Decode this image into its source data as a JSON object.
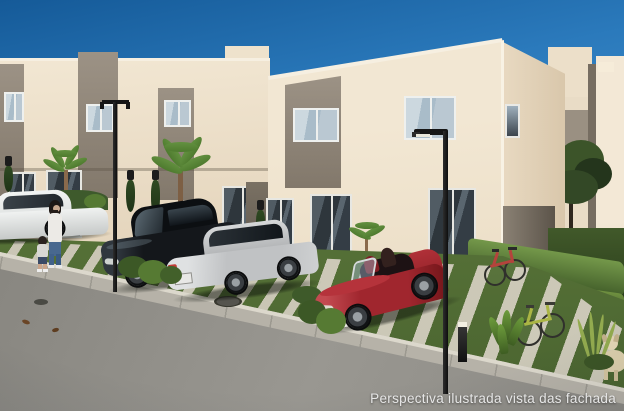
{
  "caption": {
    "text": "Perspectiva ilustrada vista das fachada"
  },
  "scene": {
    "type": "architectural-rendering",
    "subject": "Street-level view of a row of two-story beige townhouses with taupe accent panels, landscaped front yards crossed by diagonal paver walkways, parked cars (white, black, silver sedans and a red convertible), street lamps, a woman walking with a child, two bicycles, a small dog and a cobblestone street",
    "objects": [
      "sky",
      "townhouse-row",
      "front-townhouse",
      "background-buildings",
      "tree",
      "lawn",
      "paver-walkways",
      "sidewalk",
      "curb",
      "cobblestone-street",
      "manhole",
      "white-sedan",
      "black-sedan",
      "silver-sedan",
      "red-convertible",
      "street-lamp-left",
      "street-lamp-right",
      "bollard-light",
      "woman-pedestrian",
      "child-pedestrian",
      "red-bicycle",
      "green-bicycle",
      "dog",
      "palm-trees",
      "hedges",
      "shrubs",
      "wall-sconces"
    ]
  },
  "palette": {
    "sky-top": "#155a98",
    "sky-mid": "#2b7abc",
    "sky-low": "#5fa3d4",
    "wall": "#efe3ce",
    "wall-shade": "#e2d2b9",
    "wall-dark": "#6e6559",
    "accent": "#948a7c",
    "accent-dark": "#82786b",
    "roof-light": "#f6efe1",
    "frame": "#eef0ee",
    "glass-sky": "#a9bcc9",
    "glass-dark": "#343d45",
    "grass": "#5d7b3f",
    "grass-dark": "#465f2d",
    "paver": "#cfcaba",
    "sidewalk": "#b6b2a8",
    "curb": "#dcd8cc",
    "street": "#908e88",
    "hedge": "#34491f",
    "hedge-light": "#74984a",
    "tree": "#2c3e22",
    "lamp": "#161616",
    "car-black": "#14171b",
    "car-silver": "#c0c2c4",
    "car-white": "#e9ebea",
    "car-red": "#a0262e",
    "car-red-dark": "#701519",
    "dog": "#dccfac",
    "caption": "#e7e7e7"
  }
}
